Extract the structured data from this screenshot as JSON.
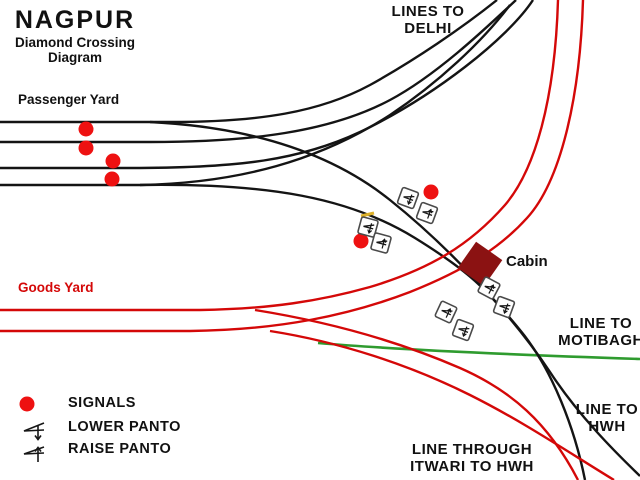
{
  "title": {
    "main": "NAGPUR",
    "sub_line1": "Diamond Crossing",
    "sub_line2": "Diagram"
  },
  "labels": {
    "passenger_yard": "Passenger Yard",
    "goods_yard": "Goods Yard",
    "lines_to_delhi_line1": "LINES TO",
    "lines_to_delhi_line2": "DELHI",
    "cabin": "Cabin",
    "line_to_motibagh_line1": "LINE TO",
    "line_to_motibagh_line2": "MOTIBAGH",
    "line_to_hwh_line1": "LINE TO",
    "line_to_hwh_line2": "HWH",
    "line_through_itwari_line1": "LINE THROUGH",
    "line_through_itwari_line2": "ITWARI TO HWH"
  },
  "legend": {
    "items": [
      {
        "symbol": "signal",
        "label": "SIGNALS"
      },
      {
        "symbol": "lower-panto",
        "label": "LOWER PANTO"
      },
      {
        "symbol": "raise-panto",
        "label": "RAISE PANTO"
      }
    ]
  },
  "colors": {
    "track_black": "#141414",
    "track_red": "#d40808",
    "track_green": "#2f9b2f",
    "signal_red": "#ee1111",
    "cabin_maroon": "#8b1212",
    "neutral_yellow": "#ddb12a"
  },
  "signals": [
    {
      "x": 86,
      "y": 129
    },
    {
      "x": 86,
      "y": 148
    },
    {
      "x": 113,
      "y": 161
    },
    {
      "x": 112,
      "y": 179
    },
    {
      "x": 431,
      "y": 192
    },
    {
      "x": 361,
      "y": 241
    }
  ],
  "panto_markers": [
    {
      "x": 408,
      "y": 198,
      "type": "lower",
      "rot": 20
    },
    {
      "x": 427,
      "y": 213,
      "type": "raise",
      "rot": 20
    },
    {
      "x": 368,
      "y": 227,
      "type": "lower",
      "rot": 15
    },
    {
      "x": 381,
      "y": 243,
      "type": "raise",
      "rot": 15
    },
    {
      "x": 489,
      "y": 288,
      "type": "raise",
      "rot": 28
    },
    {
      "x": 504,
      "y": 307,
      "type": "lower",
      "rot": 20
    },
    {
      "x": 446,
      "y": 312,
      "type": "raise",
      "rot": 25
    },
    {
      "x": 463,
      "y": 330,
      "type": "lower",
      "rot": 20
    }
  ]
}
